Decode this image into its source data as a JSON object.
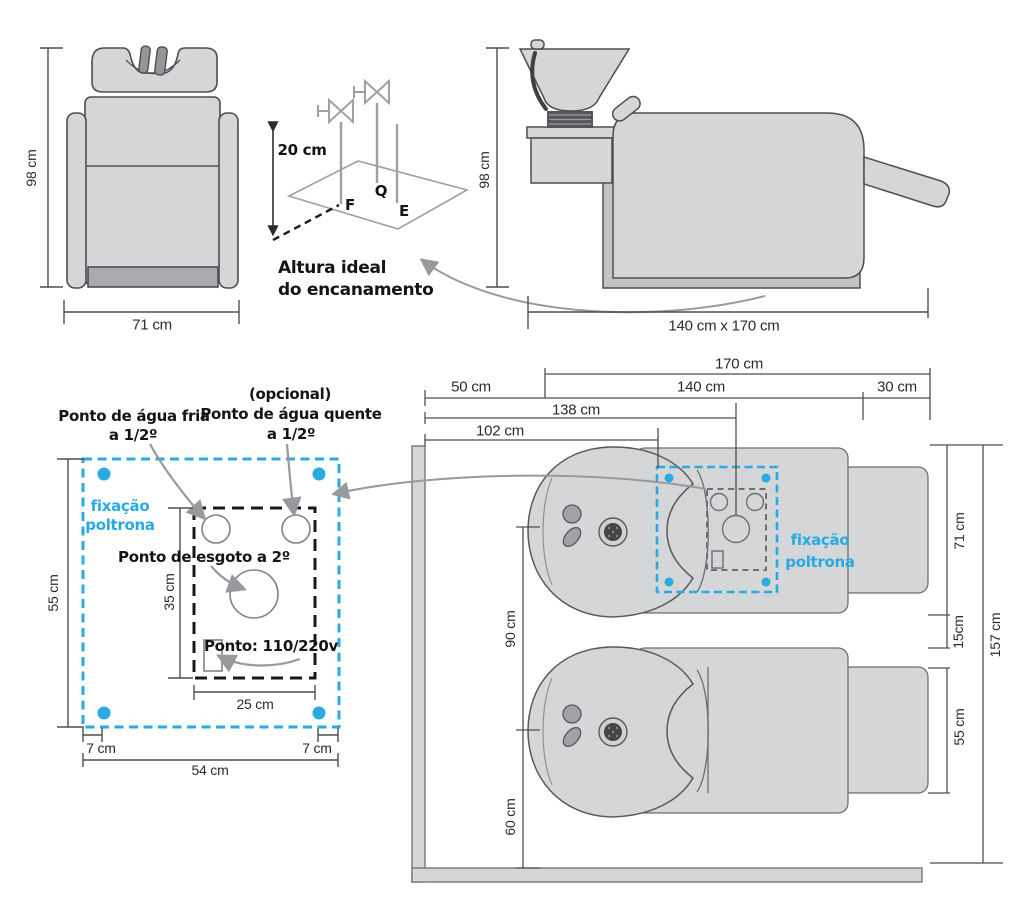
{
  "palette": {
    "accent_blue": "#29aae2",
    "line_gray": "#939598",
    "fill_gray": "#d5d6d8",
    "ink": "#2b2b2d"
  },
  "front_view": {
    "height": "98 cm",
    "width": "71 cm"
  },
  "pipe_sketch": {
    "height": "20 cm",
    "cold_tap": "F",
    "hot_tap": "Q",
    "drain": "E",
    "caption_l1": "Altura ideal",
    "caption_l2": "do encanamento"
  },
  "side_view": {
    "height": "98 cm",
    "footprint": "140 cm x 170 cm"
  },
  "fixing_detail": {
    "cold_l1": "Ponto de água fria",
    "cold_l2": "a 1/2º",
    "hot_l1": "(opcional)",
    "hot_l2": "Ponto de água quente",
    "hot_l3": "a 1/2º",
    "drain": "Ponto de esgoto a 2º",
    "power": "Ponto: 110/220v",
    "fix_l1": "fixação",
    "fix_l2": "poltrona",
    "total_h": "55 cm",
    "inner_h": "35 cm",
    "inner_w": "25 cm",
    "off_l": "7 cm",
    "off_r": "7 cm",
    "total_w": "54 cm"
  },
  "floor_plan": {
    "fix_l1": "fixação",
    "fix_l2": "poltrona",
    "total_len": "170 cm",
    "wall_gap": "50 cm",
    "unit_len": "140 cm",
    "back_gap": "30 cm",
    "drain_offset": "138 cm",
    "fix_offset": "102 cm",
    "unit_w": "71 cm",
    "gap": "15cm",
    "basin_w": "55 cm",
    "total_w": "157 cm",
    "spacing": "90 cm",
    "wall_dist": "60 cm"
  }
}
